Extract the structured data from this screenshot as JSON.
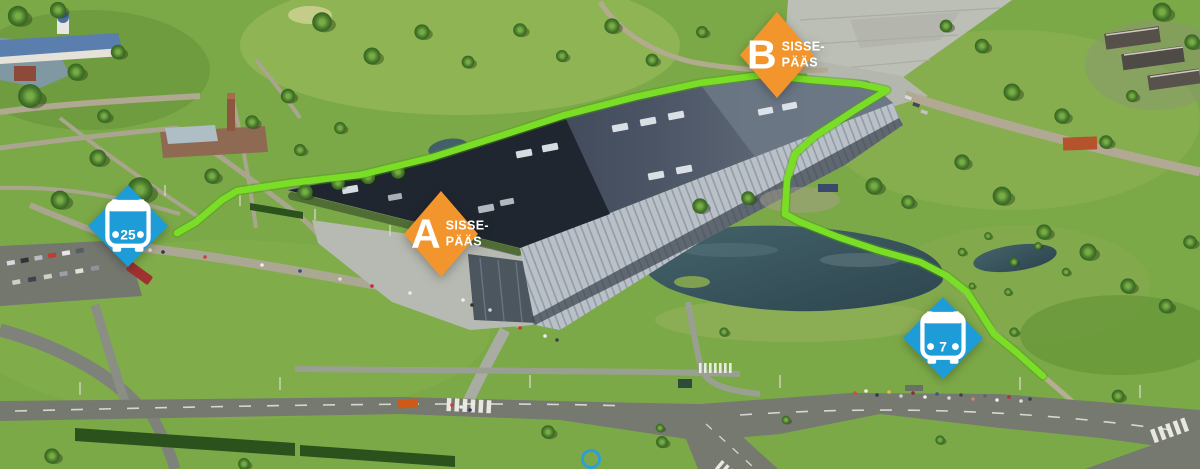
{
  "map": {
    "kind": "aerial-wayfinding-map",
    "colors": {
      "route_green": "#7ADE27",
      "route_green_edge": "#4F9E14",
      "entrance_orange": "#F2952D",
      "bus_blue": "#1E9CD7",
      "marker_text": "#FFFFFF"
    },
    "markers": {
      "entrance_a": {
        "letter": "A",
        "label_line1": "SISSE-",
        "label_line2": "PÄÄS"
      },
      "entrance_b": {
        "letter": "B",
        "label_line1": "SISSE-",
        "label_line2": "PÄÄS"
      },
      "bus_25": {
        "number": "25"
      },
      "bus_7": {
        "number": "7"
      }
    },
    "route": {
      "points": [
        [
          177,
          233
        ],
        [
          196,
          222
        ],
        [
          222,
          200
        ],
        [
          237,
          191
        ],
        [
          290,
          183
        ],
        [
          360,
          175
        ],
        [
          430,
          158
        ],
        [
          500,
          136
        ],
        [
          565,
          115
        ],
        [
          635,
          97
        ],
        [
          700,
          83
        ],
        [
          762,
          75
        ],
        [
          812,
          80
        ],
        [
          860,
          84
        ],
        [
          887,
          90
        ],
        [
          858,
          108
        ],
        [
          815,
          136
        ],
        [
          795,
          154
        ],
        [
          787,
          180
        ],
        [
          785,
          214
        ],
        [
          800,
          222
        ],
        [
          838,
          237
        ],
        [
          877,
          250
        ],
        [
          920,
          262
        ],
        [
          947,
          276
        ],
        [
          967,
          292
        ],
        [
          980,
          312
        ],
        [
          994,
          334
        ],
        [
          1016,
          352
        ],
        [
          1043,
          376
        ]
      ]
    }
  }
}
